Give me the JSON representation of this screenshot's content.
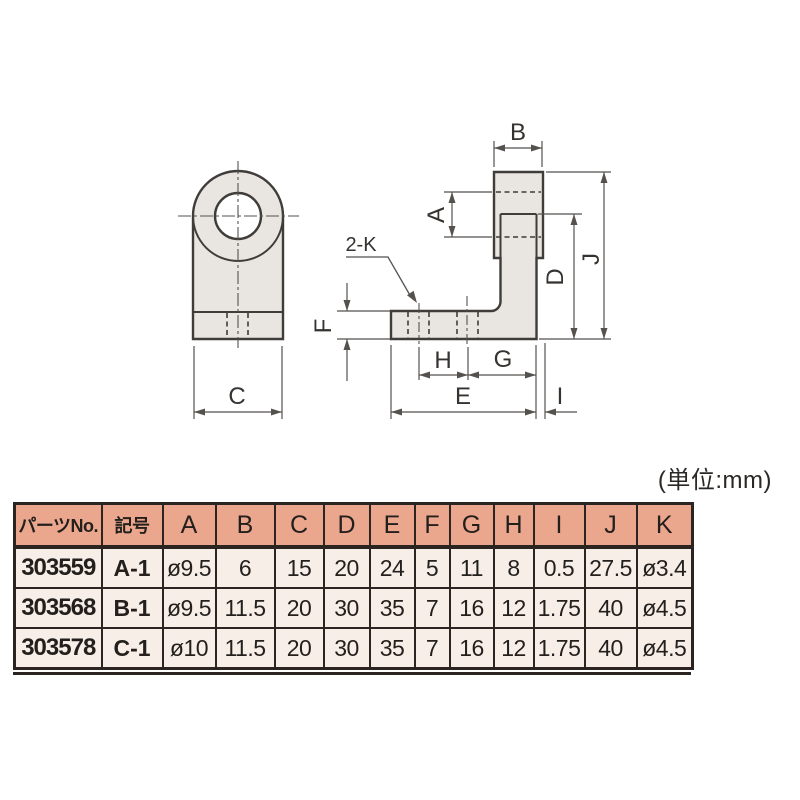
{
  "unit_note": "(単位:mm)",
  "drawing": {
    "front_view": {
      "label_c": "C"
    },
    "side_view": {
      "hole_callout": "2-K",
      "labels": {
        "a": "A",
        "b": "B",
        "d": "D",
        "e": "E",
        "f": "F",
        "g": "G",
        "h": "H",
        "i": "I",
        "j": "J"
      }
    }
  },
  "table": {
    "headers": [
      "パーツNo.",
      "記号",
      "A",
      "B",
      "C",
      "D",
      "E",
      "F",
      "G",
      "H",
      "I",
      "J",
      "K"
    ],
    "rows": [
      {
        "part_no": "303559",
        "symbol": "A-1",
        "values": [
          "ø9.5",
          "6",
          "15",
          "20",
          "24",
          "5",
          "11",
          "8",
          "0.5",
          "27.5",
          "ø3.4"
        ]
      },
      {
        "part_no": "303568",
        "symbol": "B-1",
        "values": [
          "ø9.5",
          "11.5",
          "20",
          "30",
          "35",
          "7",
          "16",
          "12",
          "1.75",
          "40",
          "ø4.5"
        ]
      },
      {
        "part_no": "303578",
        "symbol": "C-1",
        "values": [
          "ø10",
          "11.5",
          "20",
          "30",
          "35",
          "7",
          "16",
          "12",
          "1.75",
          "40",
          "ø4.5"
        ]
      }
    ]
  },
  "colors": {
    "part_fill": "#e9e6e1",
    "outline": "#3f3c39",
    "dimension_line": "#55524e",
    "table_header_bg": "#eba78d",
    "table_row_bg": "#f7eee8",
    "table_border": "#2b2420"
  }
}
